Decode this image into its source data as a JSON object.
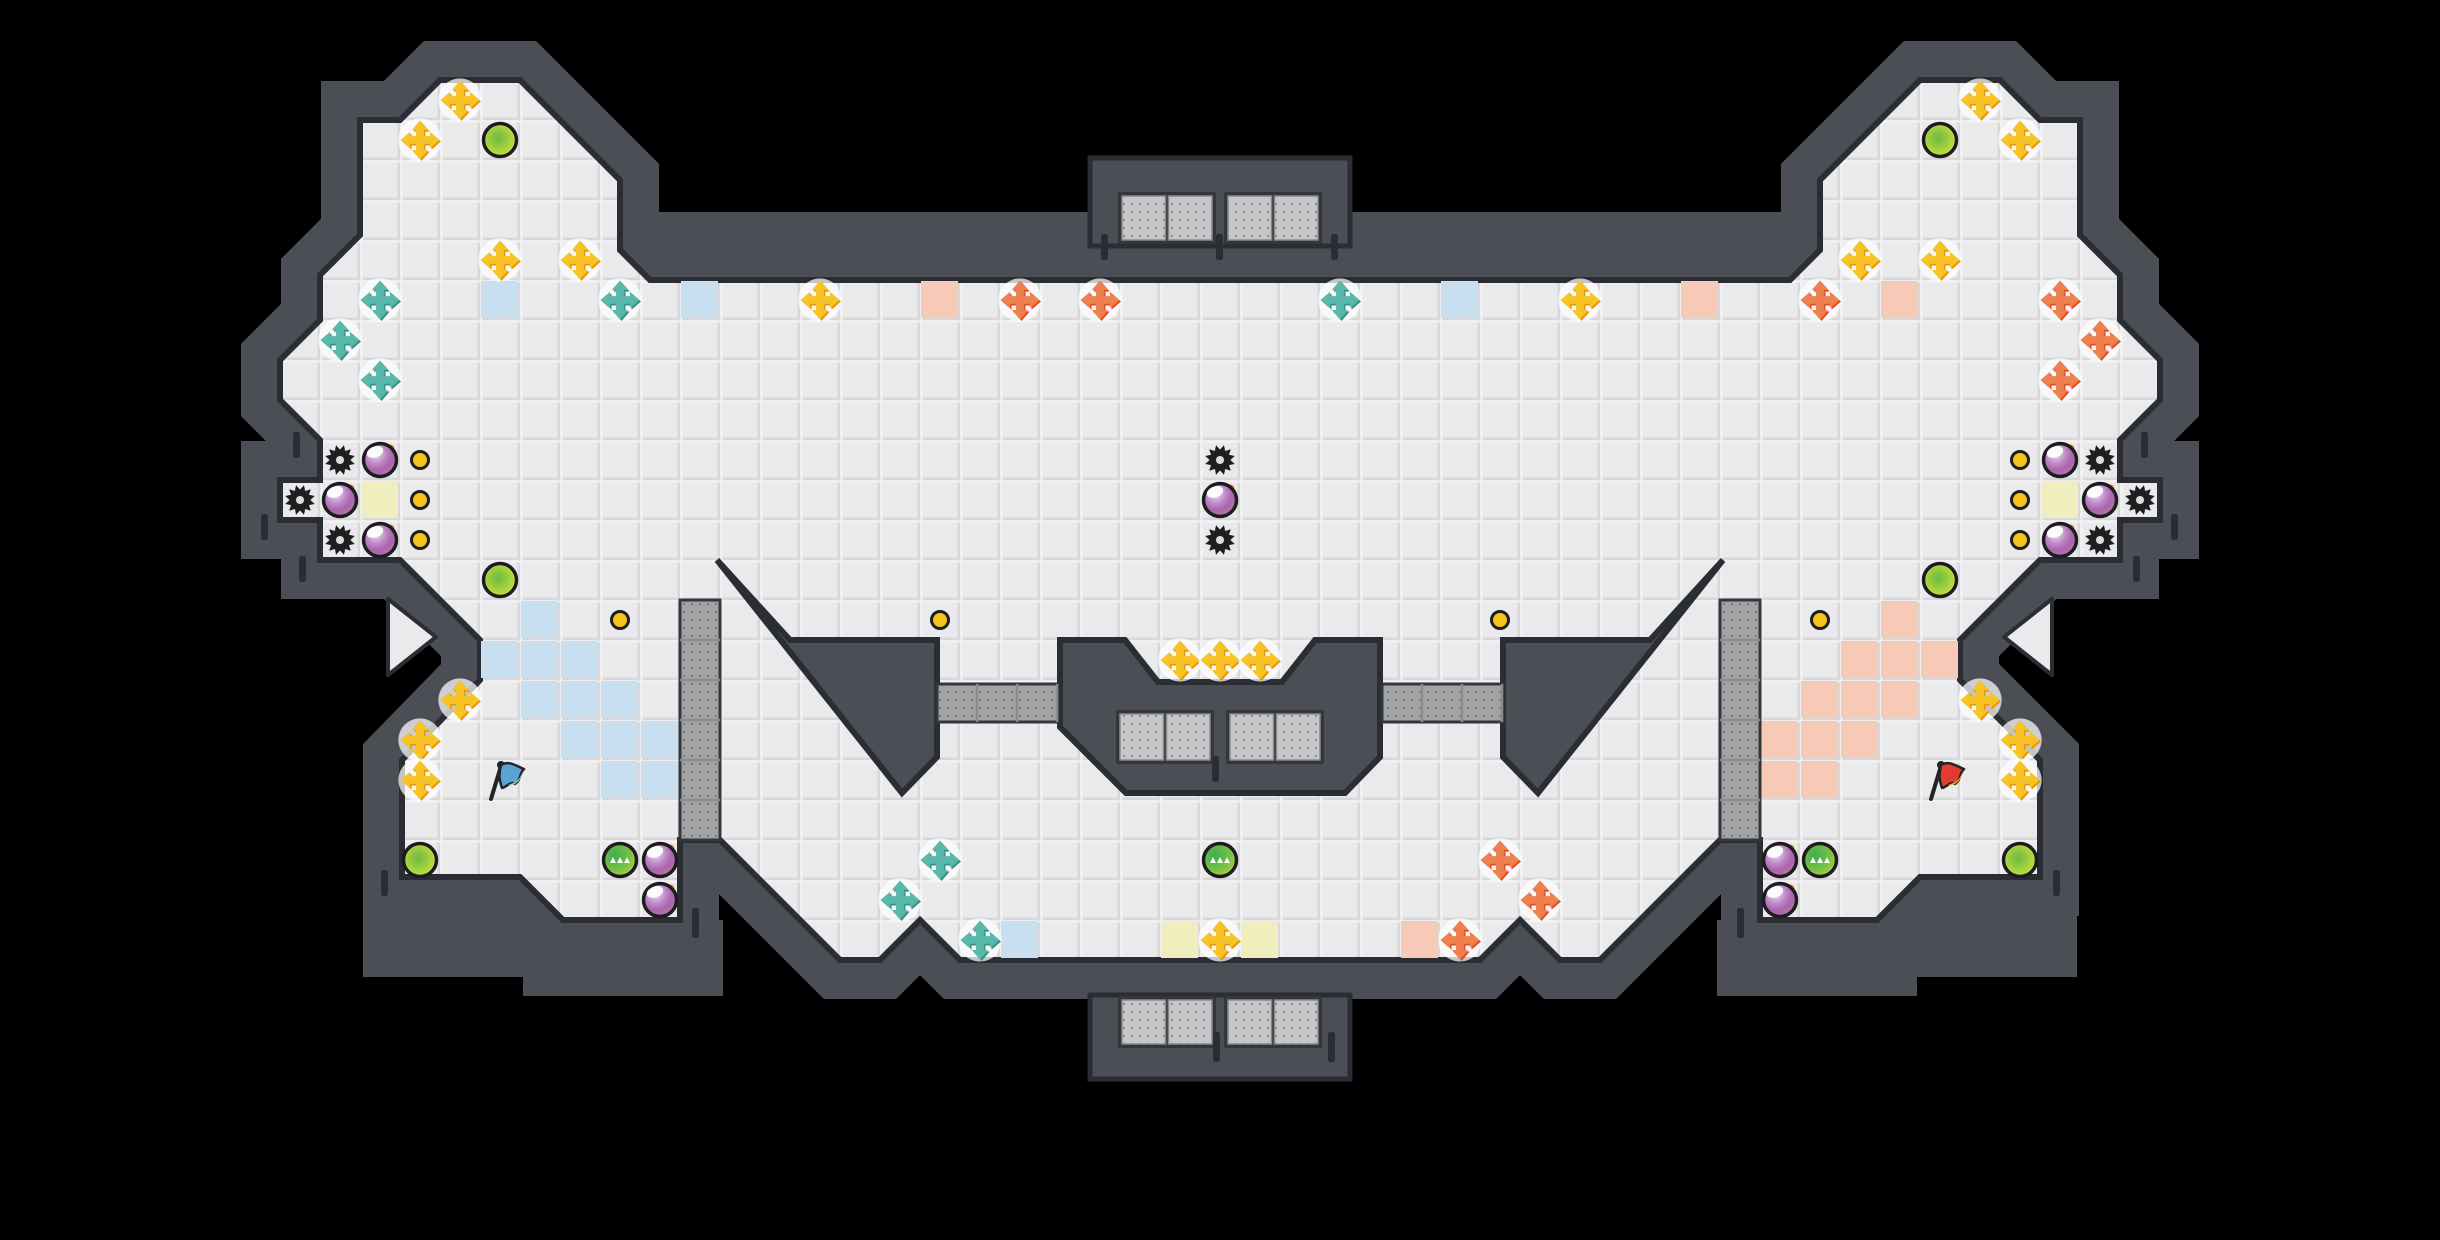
{
  "meta": {
    "view": "game-level-map",
    "map_style": "capture-the-flag tile arena",
    "tile_size": 40,
    "grid_cols": 61,
    "grid_rows": 31,
    "canvas": {
      "width": 2440,
      "height": 1240
    }
  },
  "palette": {
    "void": "#000000",
    "wall": "#4b4f55",
    "wall_dark_edge": "#2a2d33",
    "wall_frame": "#33363b",
    "floor": "#eaeaec",
    "floor_grout": "#d8d8da",
    "floor_highlight": "#f3f3f5",
    "tile_blue": "#c9dff0",
    "tile_salmon": "#f6cab7",
    "tile_pale_yellow": "#efeebc",
    "grate_light": "#c7c7c9",
    "grate_light_dot": "#909092",
    "grate_mid": "#a2a3a5",
    "grate_mid_dot": "#7a7b7d",
    "cross_yellow_main": "#f7c325",
    "cross_yellow_shade": "#e8960f",
    "cross_teal_main": "#58b8aa",
    "cross_teal_shade": "#3b9188",
    "cross_orange_main": "#f07f4e",
    "cross_orange_shade": "#dd4f28",
    "bomb_ring": "#1d1d1f",
    "bomb_hi": "#efe2f2",
    "bomb_mid": "#a964b0",
    "bomb_low": "#c0789b",
    "fuse_orange": "#f29b2e",
    "lime_ring": "#1d1d1f",
    "lime_outer": "#e3ea33",
    "lime_inner": "#6db844",
    "green_outer": "#c6db35",
    "green_inner": "#3fae4e",
    "button_gold": "#f6c51c",
    "flag_blue": "#5ba3d4",
    "flag_blue_tip": "#7ed6a0",
    "flag_red": "#e23b30",
    "flag_red_tip": "#f2a23c",
    "pole": "#232325"
  },
  "map": {
    "floor_outline": [
      [
        400,
        120
      ],
      [
        440,
        80
      ],
      [
        520,
        80
      ],
      [
        620,
        180
      ],
      [
        620,
        250
      ],
      [
        650,
        280
      ],
      [
        1790,
        280
      ],
      [
        1820,
        250
      ],
      [
        1820,
        180
      ],
      [
        1920,
        80
      ],
      [
        2000,
        80
      ],
      [
        2040,
        120
      ],
      [
        2080,
        120
      ],
      [
        2080,
        235
      ],
      [
        2120,
        275
      ],
      [
        2120,
        320
      ],
      [
        2160,
        360
      ],
      [
        2160,
        400
      ],
      [
        2120,
        440
      ],
      [
        2120,
        480
      ],
      [
        2160,
        480
      ],
      [
        2160,
        520
      ],
      [
        2120,
        520
      ],
      [
        2120,
        560
      ],
      [
        2040,
        560
      ],
      [
        1960,
        640
      ],
      [
        1960,
        680
      ],
      [
        2040,
        760
      ],
      [
        2040,
        877
      ],
      [
        1920,
        877
      ],
      [
        1877,
        920
      ],
      [
        1760,
        920
      ],
      [
        1760,
        840
      ],
      [
        1720,
        840
      ],
      [
        1600,
        960
      ],
      [
        1560,
        960
      ],
      [
        1520,
        920
      ],
      [
        1480,
        960
      ],
      [
        960,
        960
      ],
      [
        920,
        920
      ],
      [
        880,
        960
      ],
      [
        840,
        960
      ],
      [
        720,
        840
      ],
      [
        680,
        840
      ],
      [
        680,
        920
      ],
      [
        563,
        920
      ],
      [
        520,
        877
      ],
      [
        402,
        877
      ],
      [
        402,
        760
      ],
      [
        480,
        680
      ],
      [
        480,
        640
      ],
      [
        400,
        560
      ],
      [
        320,
        560
      ],
      [
        320,
        520
      ],
      [
        280,
        520
      ],
      [
        280,
        480
      ],
      [
        320,
        480
      ],
      [
        320,
        440
      ],
      [
        280,
        400
      ],
      [
        280,
        360
      ],
      [
        320,
        320
      ],
      [
        320,
        275
      ],
      [
        360,
        235
      ],
      [
        360,
        120
      ]
    ],
    "islands": {
      "left_wedge": [
        [
          717,
          560
        ],
        [
          790,
          640
        ],
        [
          937,
          640
        ],
        [
          937,
          757
        ],
        [
          902,
          793
        ]
      ],
      "right_wedge": [
        [
          1723,
          560
        ],
        [
          1650,
          640
        ],
        [
          1503,
          640
        ],
        [
          1503,
          757
        ],
        [
          1538,
          793
        ]
      ],
      "center_blob": [
        [
          1060,
          640
        ],
        [
          1125,
          640
        ],
        [
          1158,
          682
        ],
        [
          1282,
          682
        ],
        [
          1315,
          640
        ],
        [
          1380,
          640
        ],
        [
          1380,
          757
        ],
        [
          1345,
          793
        ],
        [
          1126,
          793
        ],
        [
          1093,
          760
        ],
        [
          1060,
          727
        ]
      ]
    },
    "extra_walls": [
      [
        640,
        212,
        1160,
        74
      ],
      [
        363,
        877,
        242,
        100
      ],
      [
        1835,
        877,
        242,
        100
      ],
      [
        523,
        920,
        200,
        76
      ],
      [
        1717,
        920,
        200,
        76
      ]
    ],
    "structures": {
      "top_box": {
        "x": 1090,
        "y": 158,
        "w": 260,
        "h": 88
      },
      "bottom_box": {
        "x": 1090,
        "y": 995,
        "w": 260,
        "h": 84
      }
    },
    "grate_pairs": [
      [
        1122,
        196,
        90,
        44
      ],
      [
        1228,
        196,
        90,
        44
      ],
      [
        1122,
        1000,
        90,
        44
      ],
      [
        1228,
        1000,
        90,
        44
      ],
      [
        1120,
        714,
        90,
        46
      ],
      [
        1230,
        714,
        90,
        46
      ]
    ],
    "grate_columns": [
      {
        "x": 680,
        "y": 600,
        "w": 40,
        "h": 240
      },
      {
        "x": 1720,
        "y": 600,
        "w": 40,
        "h": 240
      }
    ],
    "grate_strips": [
      {
        "x": 937,
        "y": 684,
        "w": 121,
        "h": 38
      },
      {
        "x": 1382,
        "y": 684,
        "w": 121,
        "h": 38
      }
    ],
    "wall_ticks": [
      [
        293,
        432,
        26
      ],
      [
        2141,
        432,
        26
      ],
      [
        2171,
        514,
        26
      ],
      [
        2133,
        556,
        26
      ],
      [
        261,
        514,
        26
      ],
      [
        299,
        556,
        26
      ],
      [
        1101,
        234,
        26
      ],
      [
        1216,
        234,
        26
      ],
      [
        1331,
        234,
        26
      ],
      [
        1213,
        1032,
        30
      ],
      [
        1328,
        1032,
        30
      ],
      [
        1212,
        756,
        26
      ],
      [
        692,
        908,
        30
      ],
      [
        1737,
        908,
        30
      ],
      [
        381,
        870,
        26
      ],
      [
        2053,
        870,
        26
      ]
    ],
    "spawn_markers": [
      {
        "dir": "right",
        "points": [
          [
            388,
            599
          ],
          [
            388,
            675
          ],
          [
            436,
            637
          ]
        ]
      },
      {
        "dir": "left",
        "points": [
          [
            2052,
            599
          ],
          [
            2052,
            675
          ],
          [
            2004,
            637
          ]
        ]
      }
    ]
  },
  "tiles": {
    "blue": [
      [
        12,
        7
      ],
      [
        17,
        7
      ],
      [
        36,
        7
      ],
      [
        13,
        15
      ],
      [
        12,
        16
      ],
      [
        13,
        16
      ],
      [
        14,
        16
      ],
      [
        13,
        17
      ],
      [
        14,
        17
      ],
      [
        15,
        17
      ],
      [
        14,
        18
      ],
      [
        15,
        18
      ],
      [
        16,
        18
      ],
      [
        15,
        19
      ],
      [
        16,
        19
      ],
      [
        25,
        23
      ]
    ],
    "salmon": [
      [
        23,
        7
      ],
      [
        42,
        7
      ],
      [
        47,
        7
      ],
      [
        47,
        15
      ],
      [
        46,
        16
      ],
      [
        47,
        16
      ],
      [
        48,
        16
      ],
      [
        45,
        17
      ],
      [
        46,
        17
      ],
      [
        47,
        17
      ],
      [
        44,
        18
      ],
      [
        45,
        18
      ],
      [
        46,
        18
      ],
      [
        44,
        19
      ],
      [
        45,
        19
      ],
      [
        35,
        23
      ]
    ],
    "pale_yellow": [
      [
        9,
        12
      ],
      [
        51,
        12
      ],
      [
        29,
        23
      ],
      [
        31,
        23
      ]
    ]
  },
  "entities": {
    "yellow_crosses": [
      [
        11,
        2
      ],
      [
        10,
        3
      ],
      [
        12,
        6
      ],
      [
        14,
        6
      ],
      [
        20,
        7
      ],
      [
        39,
        7
      ],
      [
        46,
        6
      ],
      [
        48,
        6
      ],
      [
        49,
        2
      ],
      [
        50,
        3
      ],
      [
        29,
        16
      ],
      [
        30,
        16
      ],
      [
        31,
        16
      ],
      [
        11,
        17
      ],
      [
        10,
        18
      ],
      [
        10,
        19
      ],
      [
        49,
        17
      ],
      [
        50,
        18
      ],
      [
        50,
        19
      ],
      [
        30,
        23
      ]
    ],
    "teal_crosses": [
      [
        9,
        7
      ],
      [
        8,
        8
      ],
      [
        9,
        9
      ],
      [
        15,
        7
      ],
      [
        33,
        7
      ],
      [
        23,
        21
      ],
      [
        22,
        22
      ],
      [
        24,
        23
      ]
    ],
    "orange_crosses": [
      [
        25,
        7
      ],
      [
        27,
        7
      ],
      [
        45,
        7
      ],
      [
        51,
        7
      ],
      [
        52,
        8
      ],
      [
        51,
        9
      ],
      [
        37,
        21
      ],
      [
        38,
        22
      ],
      [
        36,
        23
      ]
    ],
    "bombs": [
      [
        9,
        11
      ],
      [
        8,
        12
      ],
      [
        9,
        13
      ],
      [
        30,
        12
      ],
      [
        16,
        21
      ],
      [
        16,
        22
      ],
      [
        51,
        11
      ],
      [
        52,
        12
      ],
      [
        51,
        13
      ],
      [
        44,
        21
      ],
      [
        44,
        22
      ]
    ],
    "spikes": [
      [
        8,
        11
      ],
      [
        7,
        12
      ],
      [
        8,
        13
      ],
      [
        30,
        11
      ],
      [
        30,
        13
      ],
      [
        52,
        11
      ],
      [
        53,
        12
      ],
      [
        52,
        13
      ]
    ],
    "buttons": [
      [
        10,
        11
      ],
      [
        10,
        12
      ],
      [
        10,
        13
      ],
      [
        50,
        11
      ],
      [
        50,
        12
      ],
      [
        50,
        13
      ],
      [
        15,
        15
      ],
      [
        23,
        15
      ],
      [
        37,
        15
      ],
      [
        45,
        15
      ]
    ],
    "powerups_lime": [
      [
        12,
        3
      ],
      [
        48,
        3
      ],
      [
        12,
        14
      ],
      [
        48,
        14
      ],
      [
        10,
        21
      ],
      [
        50,
        21
      ]
    ],
    "powerups_green": [
      [
        15,
        21
      ],
      [
        30,
        21
      ],
      [
        45,
        21
      ]
    ],
    "flags": [
      {
        "team": "blue",
        "c": 12,
        "r": 19
      },
      {
        "team": "red",
        "c": 48,
        "r": 19
      }
    ]
  }
}
